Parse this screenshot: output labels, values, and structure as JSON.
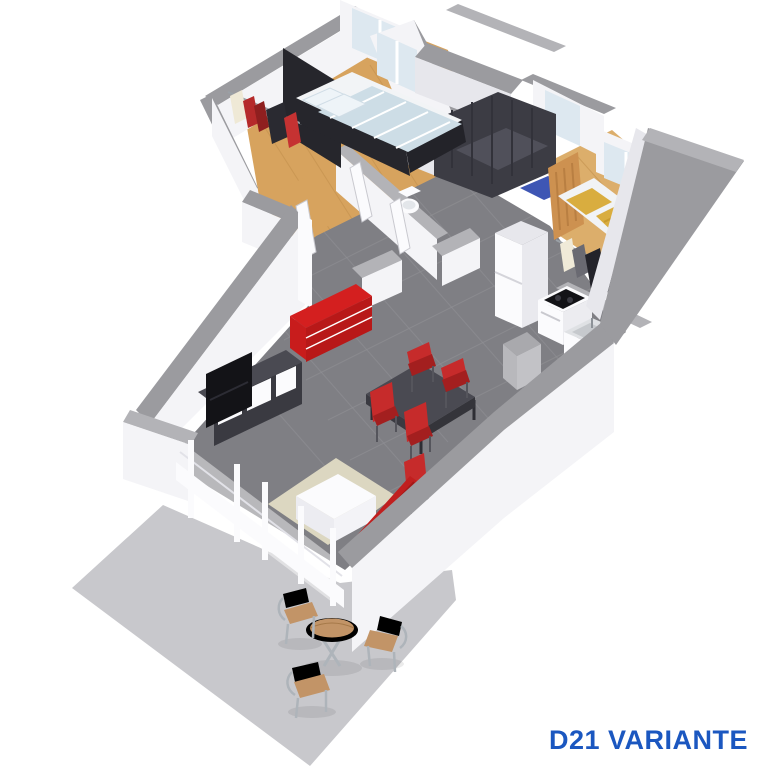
{
  "title": {
    "label": "D21 VARIANTE"
  },
  "colors": {
    "wall_cap": "#9b9b9f",
    "wall_cap_light": "#b3b3b7",
    "wall_face": "#f4f4f7",
    "wall_face_shade": "#e7e7ec",
    "floor_tile": "#7f7f84",
    "tile_line": "#909095",
    "wood": "#d7a35e",
    "wood2": "#dcae6b",
    "wood_line": "#c08e4b",
    "terrace": "#c8c8cc",
    "accent_red": "#d41f1f",
    "accent_red_dark": "#b81818",
    "sofa_red": "#c01f1f",
    "chair_red": "#c62b2b",
    "chair_red_dark": "#a31f1f",
    "dark_furniture": "#3a3a41",
    "dark_furniture_top": "#4a4a52",
    "dark_panel": "#26262c",
    "tv_black": "#131317",
    "shower_dark": "#3c3c44",
    "shower_floor": "#50505a",
    "mat_blue": "#3e56b4",
    "bed_yellow": "#d9ad3f",
    "bed_yellow_dark": "#c79a2e",
    "bed_wood": "#cd9150",
    "white_furniture": "#fbfbfd",
    "duvet_base": "#cddde6",
    "rug": "#dcd7c1",
    "glass": "#dde8f0",
    "steel": "#c6c9cd",
    "metal": "#aeb4ba",
    "label_blue": "#1b57c0"
  },
  "scene": {
    "type": "3d-floorplan-render",
    "variant_label": "D21 VARIANTE",
    "rooms": [
      {
        "name": "master-bedroom",
        "floor": "wood",
        "furniture": [
          "double-bed-striped-bedding",
          "dark-headboard-panel",
          "open-clothes-rail"
        ]
      },
      {
        "name": "bathroom",
        "floor": "tile",
        "furniture": [
          "dark-walk-in-shower",
          "vanity-with-basins",
          "blue-bath-mat"
        ]
      },
      {
        "name": "wc",
        "floor": "tile",
        "furniture": [
          "wall-hung-toilet"
        ]
      },
      {
        "name": "bedroom-2",
        "floor": "wood",
        "furniture": [
          "single-bed-yellow-bedding",
          "open-clothes-rail"
        ]
      },
      {
        "name": "kitchen",
        "floor": "tile",
        "furniture": [
          "fridge",
          "stove-with-black-cooktop",
          "sink-unit"
        ]
      },
      {
        "name": "living-dining-room",
        "floor": "tile",
        "furniture": [
          "red-sideboard",
          "tv-on-dark-bench",
          "dark-dining-table",
          "red-chairs",
          "white-coffee-table",
          "beige-rug",
          "red-sofa",
          "sliding-glass-door"
        ]
      },
      {
        "name": "terrace",
        "floor": "concrete",
        "furniture": [
          "round-bistro-table",
          "outdoor-chairs"
        ]
      }
    ],
    "counts": {
      "red_dining_chairs": 5,
      "terrace_chairs": 3,
      "windows_visible": 5
    }
  }
}
